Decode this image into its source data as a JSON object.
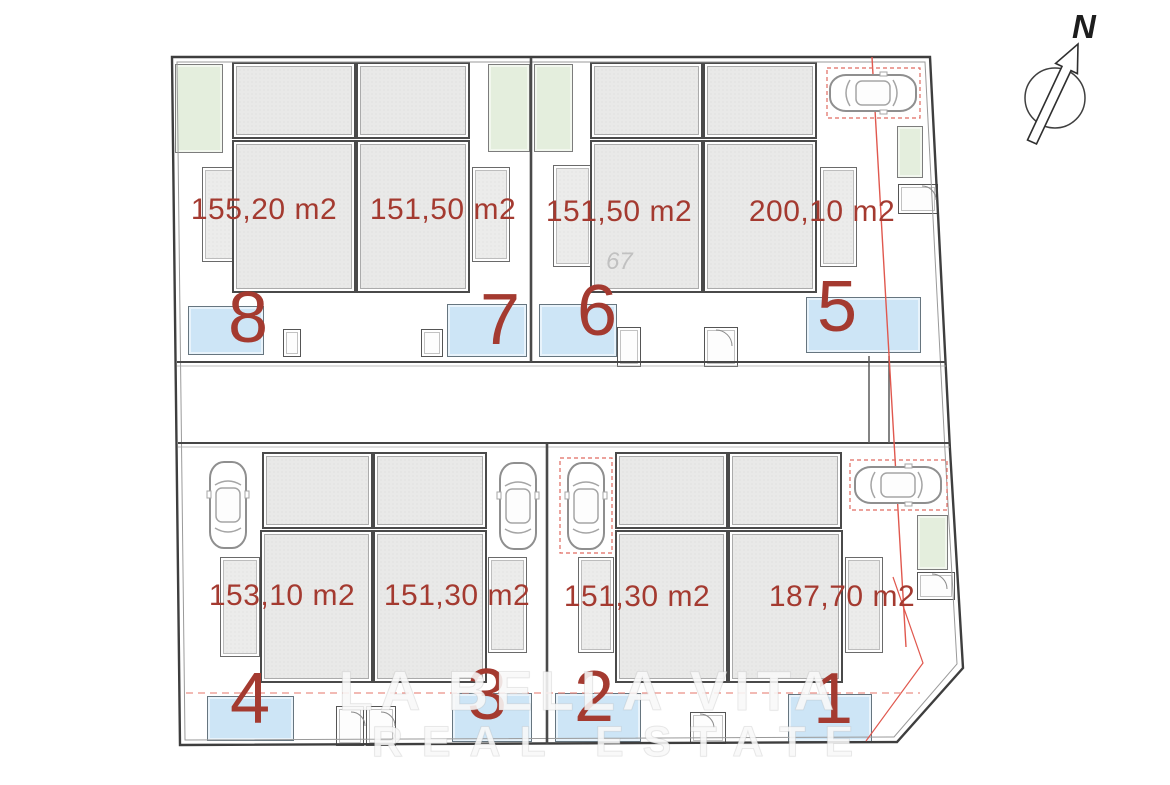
{
  "plan": {
    "compass_label": "N",
    "stray_mark": "67",
    "watermark": {
      "line1": "LA BELLA VITA",
      "line2": "REAL ESTATE"
    },
    "plots": [
      {
        "number": "1",
        "area": "187,70 m2"
      },
      {
        "number": "2",
        "area": "151,30 m2"
      },
      {
        "number": "3",
        "area": "151,30 m2"
      },
      {
        "number": "4",
        "area": "153,10 m2"
      },
      {
        "number": "5",
        "area": "200,10 m2"
      },
      {
        "number": "6",
        "area": "151,50 m2"
      },
      {
        "number": "7",
        "area": "151,50 m2"
      },
      {
        "number": "8",
        "area": "155,20 m2"
      }
    ],
    "icons": {
      "compass": "north-arrow-icon",
      "car": "car-icon",
      "pool": "pool-shape",
      "garden": "garden-patch"
    },
    "colors": {
      "label_red": "#a43a30",
      "boundary_red": "#e0584e",
      "pool_blue": "#cde5f6",
      "garden_green": "#e4eedd",
      "building_gray": "#e9e9e8",
      "outline_dark": "#3e3e3e"
    }
  }
}
